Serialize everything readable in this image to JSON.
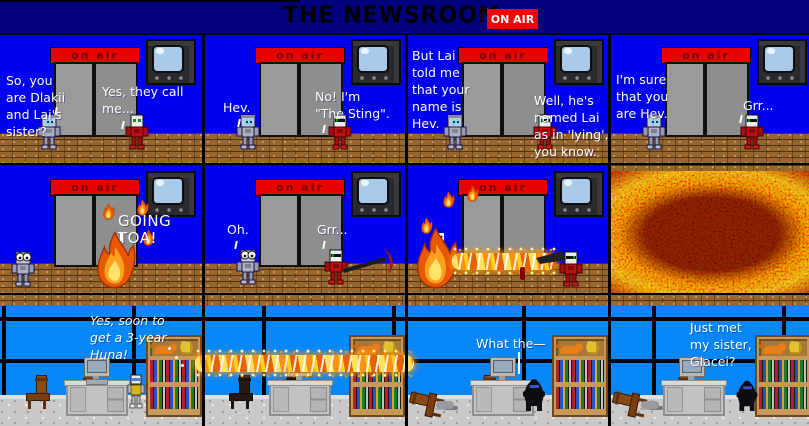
{
  "header": {
    "title": "THE NEWSROOM",
    "on_air": "ON AIR"
  },
  "elevator": {
    "sign": "on air"
  },
  "row1": [
    {
      "left": "So, you\nare Dlakii\nand Lai's\nsister?",
      "right": "Yes, they call\nme..."
    },
    {
      "left": "Hev.",
      "right": "No!  I'm\n\"The Sting\"."
    },
    {
      "left": "But Lai\ntold me\nthat your\nname is\nHev.",
      "right": "Well, he's\nnamed Lai\nas in 'lying',\nyou know."
    },
    {
      "left": "I'm sure\nthat you\nare Hev.",
      "right": "Grr..."
    }
  ],
  "row2": [
    {
      "shout": "GOING TOA!"
    },
    {
      "left": "Oh.",
      "right": "Grr..."
    },
    {},
    {}
  ],
  "row3": [
    {
      "thought": "Yes, soon to\nget a 3-year\nHuna!"
    },
    {},
    {
      "speech": "What the—"
    },
    {
      "speech": "Just met\nmy sister,\nGlacei?"
    }
  ],
  "colors": {
    "on_air_red": "#EE0404",
    "wall_blue": "#0101F2",
    "window_blue": "#0887FA",
    "header_navy": "#01017E"
  },
  "icons": {
    "tv": "tv-icon",
    "elevator_doors": "elevator-doors-icon",
    "on_air_sign": "elevator-on-air-sign",
    "flame": "flame-icon",
    "explosion": "explosion-fire",
    "scythe": "scythe-icon",
    "bookshelf": "bookshelf",
    "cat": "cat-icon",
    "computer": "computer-monitor"
  }
}
